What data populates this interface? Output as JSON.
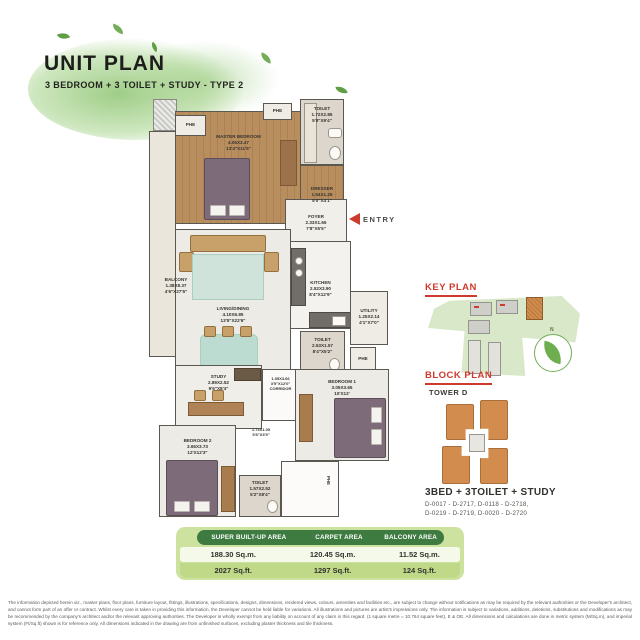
{
  "header": {
    "title": "UNIT PLAN",
    "subtitle": "3 BEDROOM + 3 TOILET + STUDY - TYPE 2"
  },
  "colors": {
    "accent_red": "#cf3a2e",
    "leaf_green": "#5f9e45",
    "table_dark_green": "#3d7b40",
    "table_light_green": "#cde29f",
    "highlight_orange": "#d28c4e"
  },
  "floorplan": {
    "entry_label": "ENTRY",
    "phe_label": "PHE",
    "rooms": {
      "master_bedroom": {
        "name": "MASTER BEDROOM",
        "m": "4.05X3.47",
        "ft": "13'4\"X11'5\""
      },
      "toilet_master": {
        "name": "TOILET",
        "m": "1.72X2.85",
        "ft": "5'8\"X9'4\""
      },
      "dresser": {
        "name": "DRESSER",
        "m": "1.54X1.25",
        "ft": "5'0\"X4'1\""
      },
      "balcony": {
        "name": "BALCONY",
        "m": "1.38X8.37",
        "ft": "4'6\"X27'5\""
      },
      "foyer": {
        "name": "FOYER",
        "m": "2.33X1.65",
        "ft": "7'8\"X5'5\""
      },
      "living_dining": {
        "name": "LIVING/DINING",
        "m": "4.10X6.85",
        "ft": "13'5\"X22'6\""
      },
      "kitchen": {
        "name": "KITCHEN",
        "m": "2.52X3.90",
        "ft": "8'4\"X12'9\""
      },
      "utility": {
        "name": "UTILITY",
        "m": "1.25X2.14",
        "ft": "4'1\"X7'0\""
      },
      "toilet_common": {
        "name": "TOILET",
        "m": "2.53X1.57",
        "ft": "8'4\"X5'2\""
      },
      "study": {
        "name": "STUDY",
        "m": "2.89X2.52",
        "ft": "9'6\"X8'4\""
      },
      "corridor": {
        "name": "CORRIDOR",
        "m": "1.05X3.66",
        "ft": "3'5\"X12'0\""
      },
      "passage": {
        "name": "",
        "m": "1.73X1.05",
        "ft": "5'8\"X3'5\""
      },
      "bedroom1": {
        "name": "BEDROOM 1",
        "m": "3.05X3.65",
        "ft": "10'X12'"
      },
      "bedroom2": {
        "name": "BEDROOM 2",
        "m": "3.65X3.73",
        "ft": "12'X12'3\""
      },
      "toilet2": {
        "name": "TOILET",
        "m": "1.57X2.52",
        "ft": "5'2\"X8'4\""
      }
    }
  },
  "key_plan": {
    "title": "KEY PLAN"
  },
  "block_plan": {
    "title": "BLOCK PLAN",
    "tower": "TOWER D",
    "unit_type": "3BED + 3TOILET + STUDY",
    "units_line1": "D-0017 - D-2717, D-0118 - D-2718,",
    "units_line2": "D-0219 - D-2719, D-0020 - D-2720"
  },
  "area_table": {
    "headers": [
      "SUPER BUILT-UP AREA",
      "CARPET AREA",
      "BALCONY AREA"
    ],
    "sqm": [
      "188.30 Sq.m.",
      "120.45 Sq.m.",
      "11.52 Sq.m."
    ],
    "sqft": [
      "2027 Sq.ft.",
      "1297 Sq.ft.",
      "124 Sq.ft."
    ]
  },
  "disclaimer": {
    "text": "The information depicted herein viz., master plans, floor plans, furniture layout, fittings, illustrations, specifications, designs, dimensions, rendered views, colours, amenities and facilities etc., are subject to change without notifications as may be required by the relevant authorities or the Developer's architect, and cannot form part of an offer or contract. Whilst every care is taken in providing this information, the Developer cannot be held liable for variations. All illustrations and pictures are artist's impressions only. The information is subject to variations, additions, deletions, substitutions and modifications as may be recommended by the company's architect and/or the relevant approving authorities. The Developer is wholly exempt from any liability on account of any claim in this regard. (1 square metre = 10.764 square feet), E & OE. All dimensions and calculations are done in metric system (M/Sq.m), and imperial system (Ft/Sq.ft) shown is for reference only. All dimensions indicated in the drawing are from unfinished surfaces, excluding plaster thickness and tile thickness."
  }
}
